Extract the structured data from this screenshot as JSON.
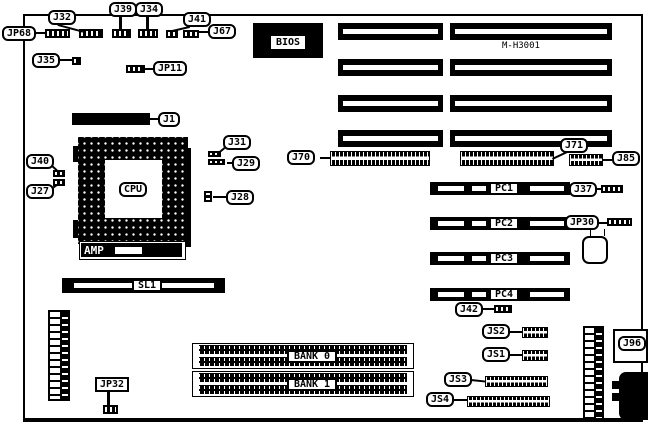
{
  "board": {
    "model": "M-H3001"
  },
  "chips": {
    "bios": "BIOS",
    "cpu": "CPU",
    "amp": "AMP"
  },
  "slots": {
    "sl1": "SL1",
    "pc1": "PC1",
    "pc2": "PC2",
    "pc3": "PC3",
    "pc4": "PC4",
    "bank0": "BANK 0",
    "bank1": "BANK 1"
  },
  "callouts": {
    "jp68": "JP68",
    "j32": "J32",
    "j39": "J39",
    "j34": "J34",
    "j41": "J41",
    "j67": "J67",
    "j35": "J35",
    "jp11": "JP11",
    "j1": "J1",
    "j31": "J31",
    "j29": "J29",
    "j40": "J40",
    "j27": "J27",
    "j28": "J28",
    "j70": "J70",
    "j71": "J71",
    "j85": "J85",
    "j37": "J37",
    "jp30": "JP30",
    "j42": "J42",
    "js2": "JS2",
    "js1": "JS1",
    "js3": "JS3",
    "js4": "JS4",
    "j96": "J96",
    "jp32": "JP32"
  },
  "colors": {
    "ink": "#000000",
    "paper": "#ffffff"
  }
}
